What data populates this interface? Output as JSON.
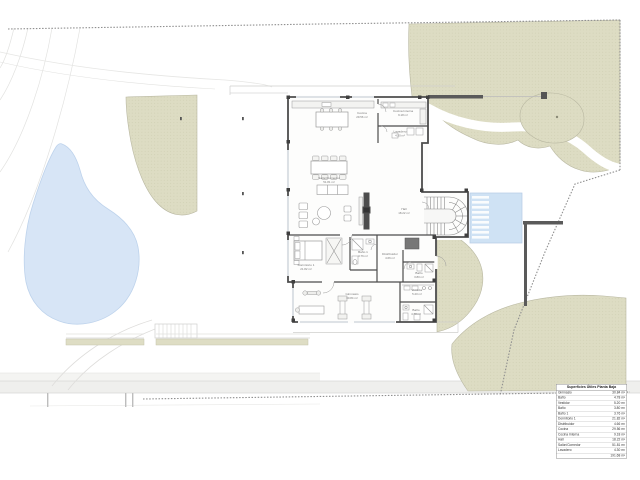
{
  "colors": {
    "vegetation": "#dddcc3",
    "pool": "#d7e5f6",
    "wall": "#4d4d4d",
    "water_feature": "#cfe2f4",
    "boundary": "#8f8f8f"
  },
  "plan_labels": [
    {
      "id": "cocina",
      "name": "Cocina",
      "area": "29.56 m²"
    },
    {
      "id": "cocina-interna",
      "name": "Cocina Interna",
      "area": "9.18 m²"
    },
    {
      "id": "lavadero",
      "name": "Lavadero",
      "area": "4.30 m²"
    },
    {
      "id": "salon-comedor",
      "name": "Salón/Comedor",
      "area": "51.81 m²"
    },
    {
      "id": "hall",
      "name": "Hall",
      "area": "18.22 m²"
    },
    {
      "id": "dormitorio-1",
      "name": "Dormitorio 1",
      "area": "21.82 m²"
    },
    {
      "id": "bano-1",
      "name": "Baño 1",
      "area": "3.76 m²"
    },
    {
      "id": "distribuidor",
      "name": "Distribuidor",
      "area": "4.66 m²"
    },
    {
      "id": "bano-entrada",
      "name": "Baño",
      "area": "3.80 m²"
    },
    {
      "id": "gimnasio",
      "name": "Gimnasio",
      "area": "30.84 m²"
    },
    {
      "id": "vestidor",
      "name": "Vestidor",
      "area": "5.20 m²"
    },
    {
      "id": "bano-gimnasio",
      "name": "Baño",
      "area": "4.78 m²"
    }
  ],
  "legend_table": {
    "title": "Superficies Útiles Planta Baja",
    "rows": [
      {
        "name": "Gimnasio",
        "area": "30.84 m²"
      },
      {
        "name": "Baño",
        "area": "4.78 m²"
      },
      {
        "name": "Vestidor",
        "area": "5.20 m²"
      },
      {
        "name": "Baño",
        "area": "3.80 m²"
      },
      {
        "name": "Baño 1",
        "area": "3.76 m²"
      },
      {
        "name": "Dormitorio 1",
        "area": "21.82 m²"
      },
      {
        "name": "Distribuidor",
        "area": "4.66 m²"
      },
      {
        "name": "Cocina",
        "area": "29.56 m²"
      },
      {
        "name": "Cocina Interna",
        "area": "9.18 m²"
      },
      {
        "name": "Hall",
        "area": "18.22 m²"
      },
      {
        "name": "Salón/Comedor",
        "area": "51.81 m²"
      },
      {
        "name": "Lavadero",
        "area": "4.30 m²"
      }
    ],
    "total": {
      "name": "",
      "area": "191.68 m²"
    }
  }
}
